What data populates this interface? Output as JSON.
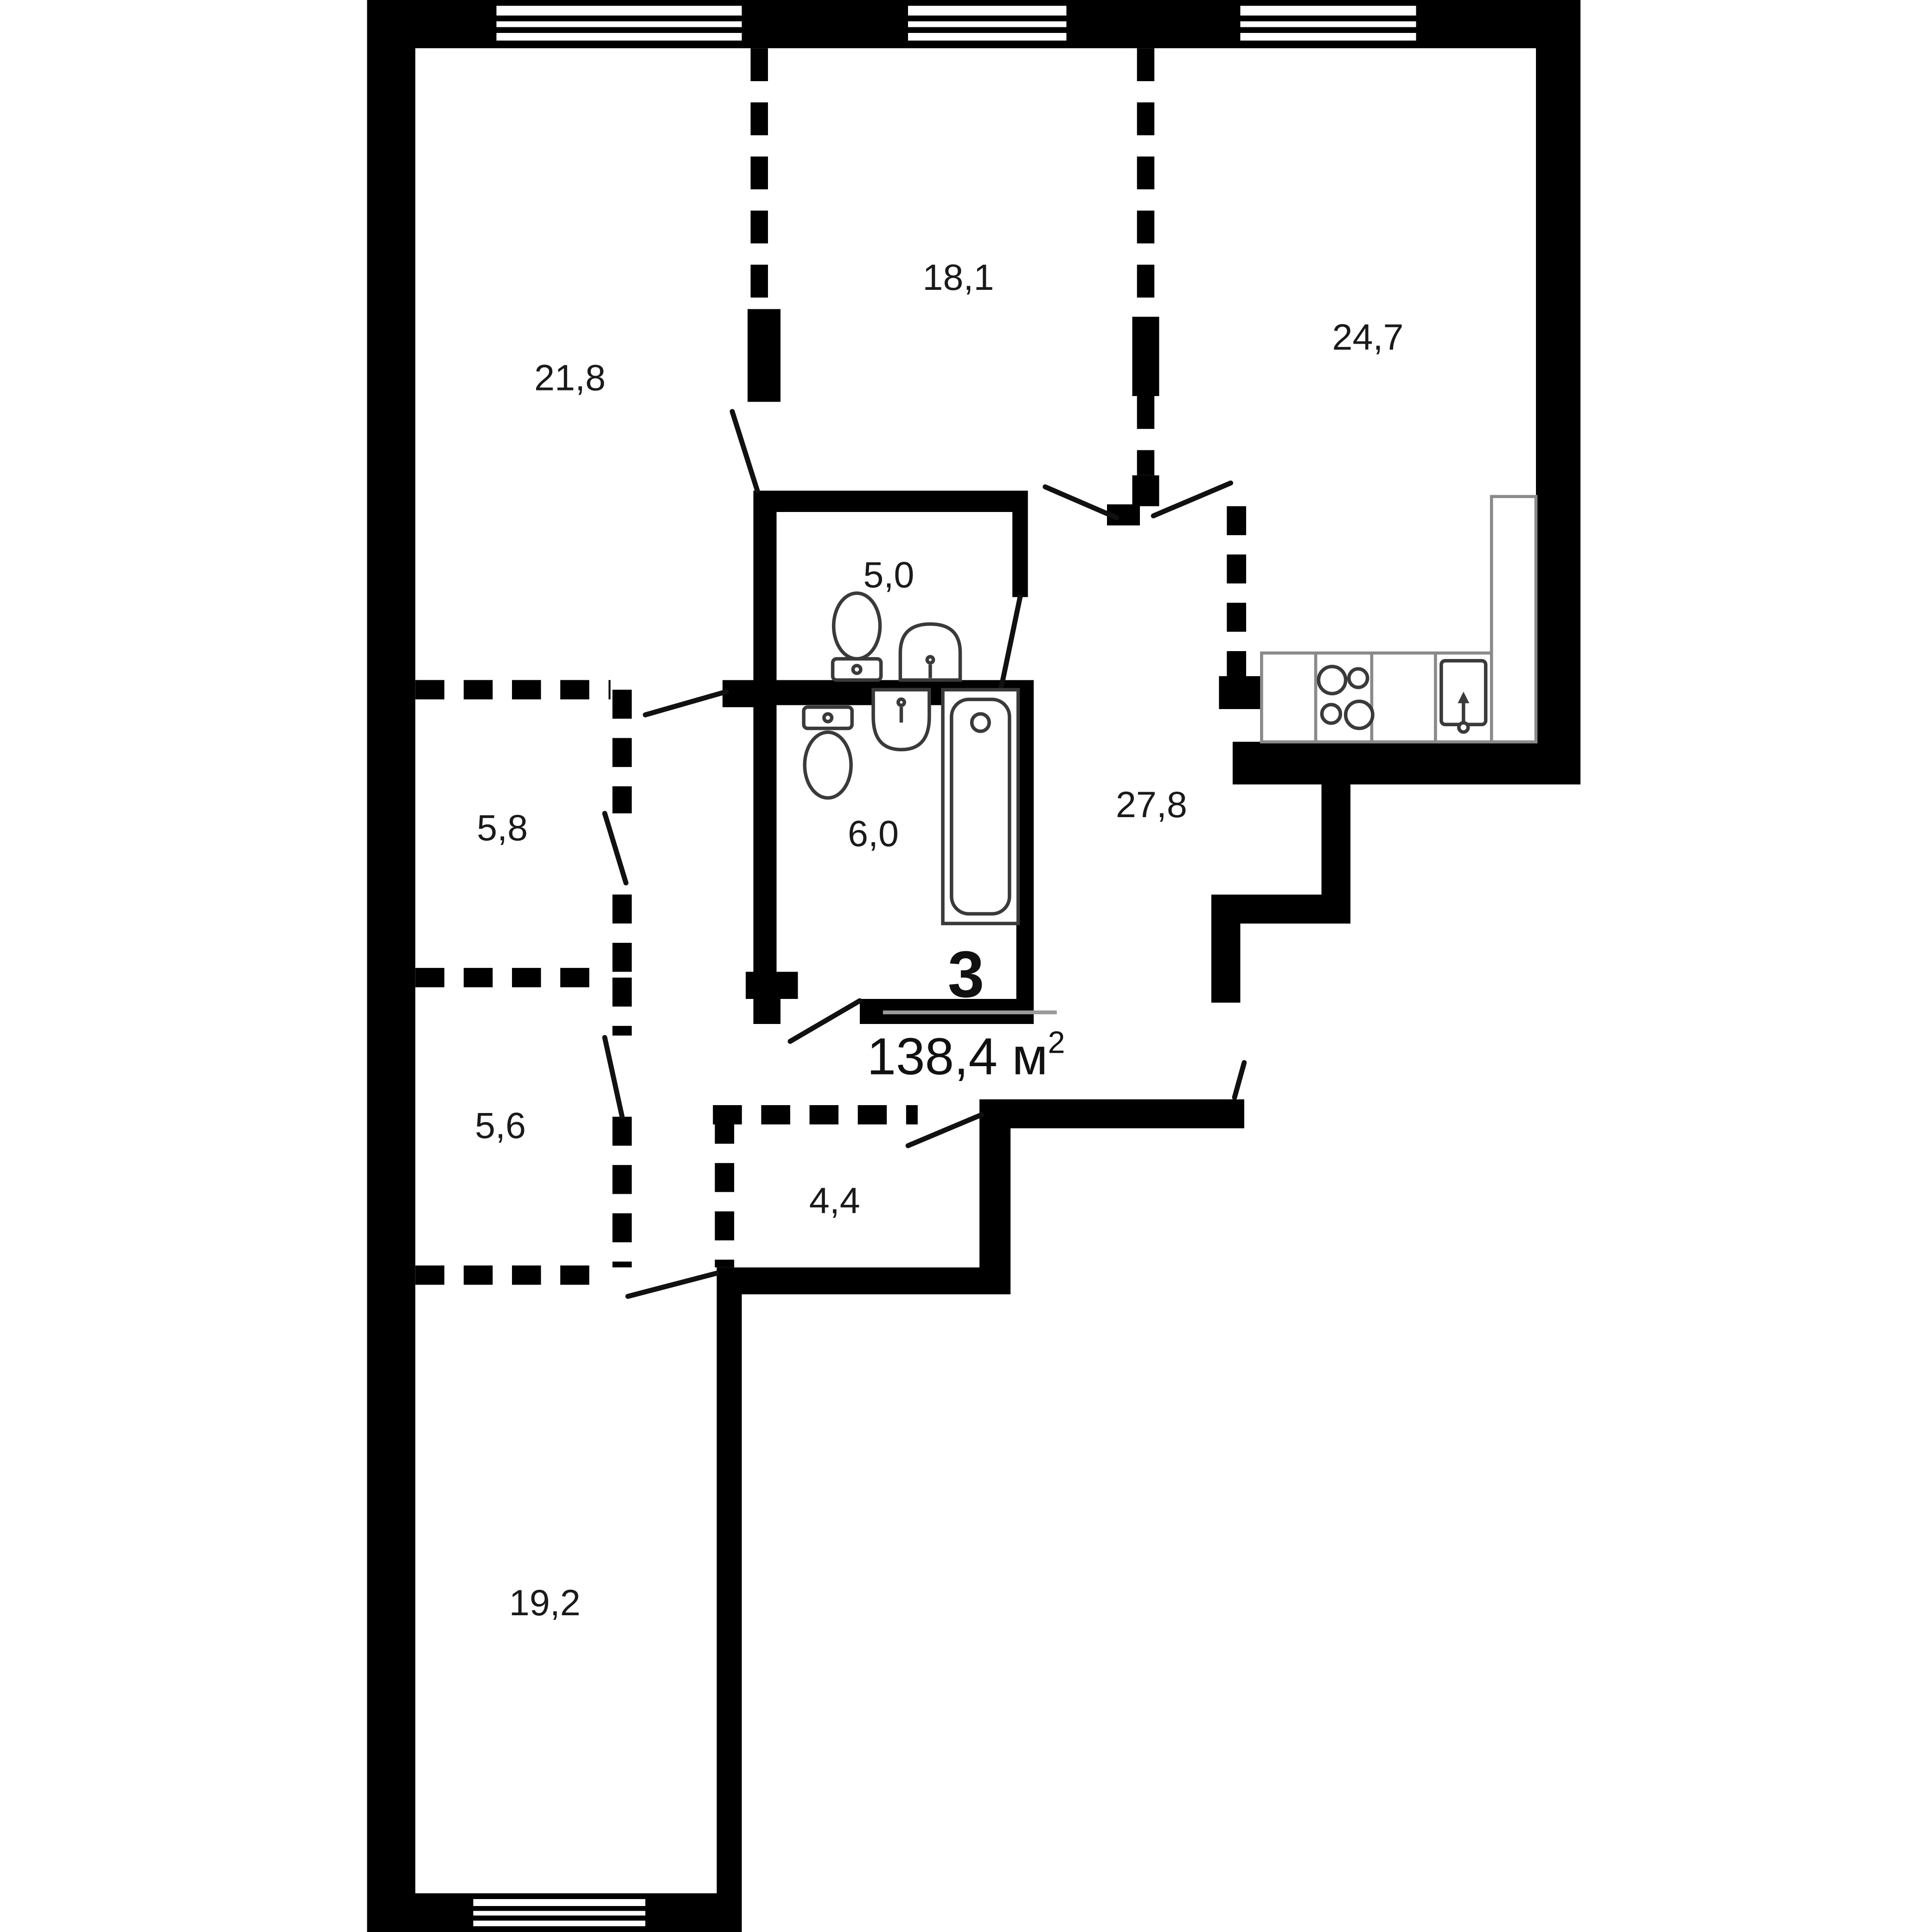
{
  "floor_plan": {
    "apartment": {
      "number": "3",
      "area_value": "138,4",
      "area_unit": " м",
      "area_superscript": "2"
    },
    "rooms": [
      {
        "id": "room-top-left",
        "area": "21,8"
      },
      {
        "id": "room-top-middle",
        "area": "18,1"
      },
      {
        "id": "kitchen-living",
        "area": "24,7"
      },
      {
        "id": "wc",
        "area": "5,0"
      },
      {
        "id": "closet-upper",
        "area": "5,8"
      },
      {
        "id": "bathroom",
        "area": "6,0"
      },
      {
        "id": "hallway",
        "area": "27,8"
      },
      {
        "id": "closet-lower",
        "area": "5,6"
      },
      {
        "id": "storage",
        "area": "4,4"
      },
      {
        "id": "room-bottom",
        "area": "19,2"
      }
    ],
    "icons": [
      "toilet-icon",
      "sink-icon",
      "bathtub-icon",
      "stove-icon",
      "kitchen-sink-icon",
      "window-icon",
      "door-swing-icon"
    ],
    "colors": {
      "wall": "#000000",
      "background": "#ffffff",
      "fixture_stroke": "#3a3a3a",
      "counter_stroke": "#8a8a8a",
      "separator_line": "#9a9a9a",
      "text": "#1a1a1a"
    }
  }
}
